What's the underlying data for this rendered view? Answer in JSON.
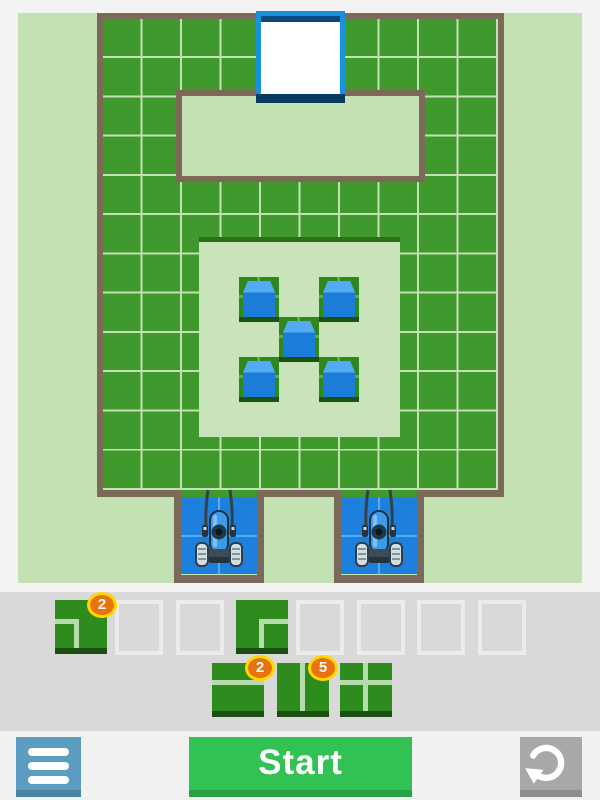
{
  "game": {
    "board": {
      "exit": {
        "name": "exit-door",
        "style": "white square with blue frame"
      },
      "cubes_count": 5,
      "mower_docks_count": 2,
      "grid": {
        "columns": 10,
        "rows": 12
      }
    },
    "tray": {
      "row1": [
        {
          "type": "corner-left",
          "count": "2"
        },
        {
          "type": "empty",
          "count": ""
        },
        {
          "type": "empty",
          "count": ""
        },
        {
          "type": "corner-right",
          "count": ""
        },
        {
          "type": "empty",
          "count": ""
        },
        {
          "type": "empty",
          "count": ""
        },
        {
          "type": "empty",
          "count": ""
        },
        {
          "type": "empty",
          "count": ""
        }
      ],
      "row2": [
        {
          "type": "split-horizontal",
          "count": "2"
        },
        {
          "type": "split-vertical",
          "count": "5"
        },
        {
          "type": "cross",
          "count": ""
        }
      ]
    },
    "controls": {
      "start_label": "Start",
      "menu_icon": "hamburger",
      "reset_icon": "rotate-ccw"
    },
    "colors": {
      "grass": "#3f992d",
      "panel_green": "#c3e1b2",
      "wall_brown": "#7b695a",
      "water_blue": "#1d80dd",
      "cube_blue": "#1b7cd9",
      "exit_frame_blue": "#1992dc",
      "badge_orange": "#e8720c",
      "badge_ring_yellow": "#ffd700",
      "start_green": "#32c253",
      "menu_blue": "#5b9dc0",
      "reset_gray": "#a8a8a8"
    }
  }
}
